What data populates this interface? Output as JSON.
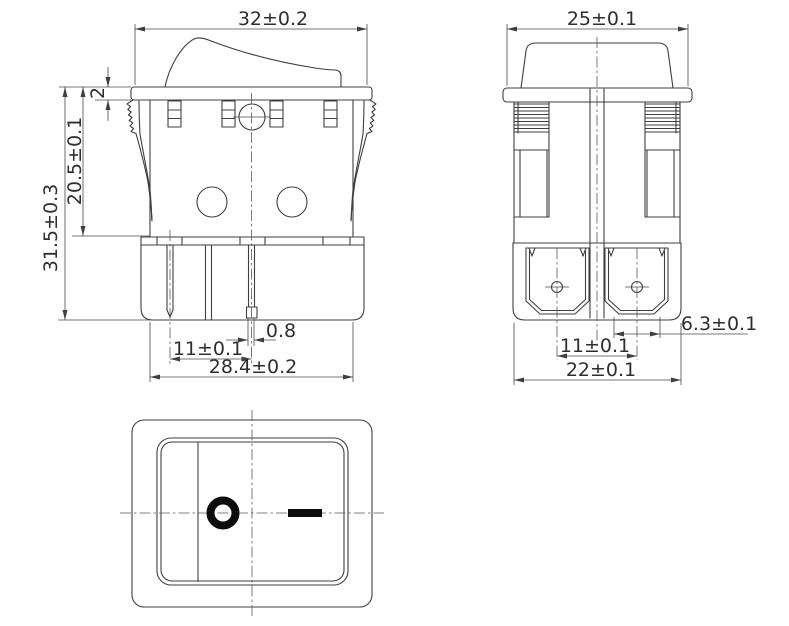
{
  "drawing_type": "rocker switch dimensional drawing, three orthographic views",
  "views": {
    "front": {
      "label": "front-view",
      "dims": {
        "width_top": "32±0.2",
        "flange_thickness": "2",
        "body_height": "20.5±0.1",
        "total_height": "31.5±0.3",
        "terminal_thickness": "0.8",
        "terminal_pitch": "11±0.1",
        "body_width": "28.4±0.2"
      }
    },
    "side": {
      "label": "side-view",
      "dims": {
        "width_top": "25±0.1",
        "terminal_width": "6.3±0.1",
        "terminal_pitch": "11±0.1",
        "body_width": "22±0.1"
      }
    },
    "top": {
      "label": "top-view",
      "off_symbol": "O",
      "on_symbol": "—"
    }
  },
  "colors": {
    "line": "#3f3f3f",
    "dimension": "#4a4a4a",
    "centerline": "#5a5a5a",
    "text": "#2e2e2e",
    "symbol": "#0d0d0d",
    "background": "#ffffff"
  }
}
